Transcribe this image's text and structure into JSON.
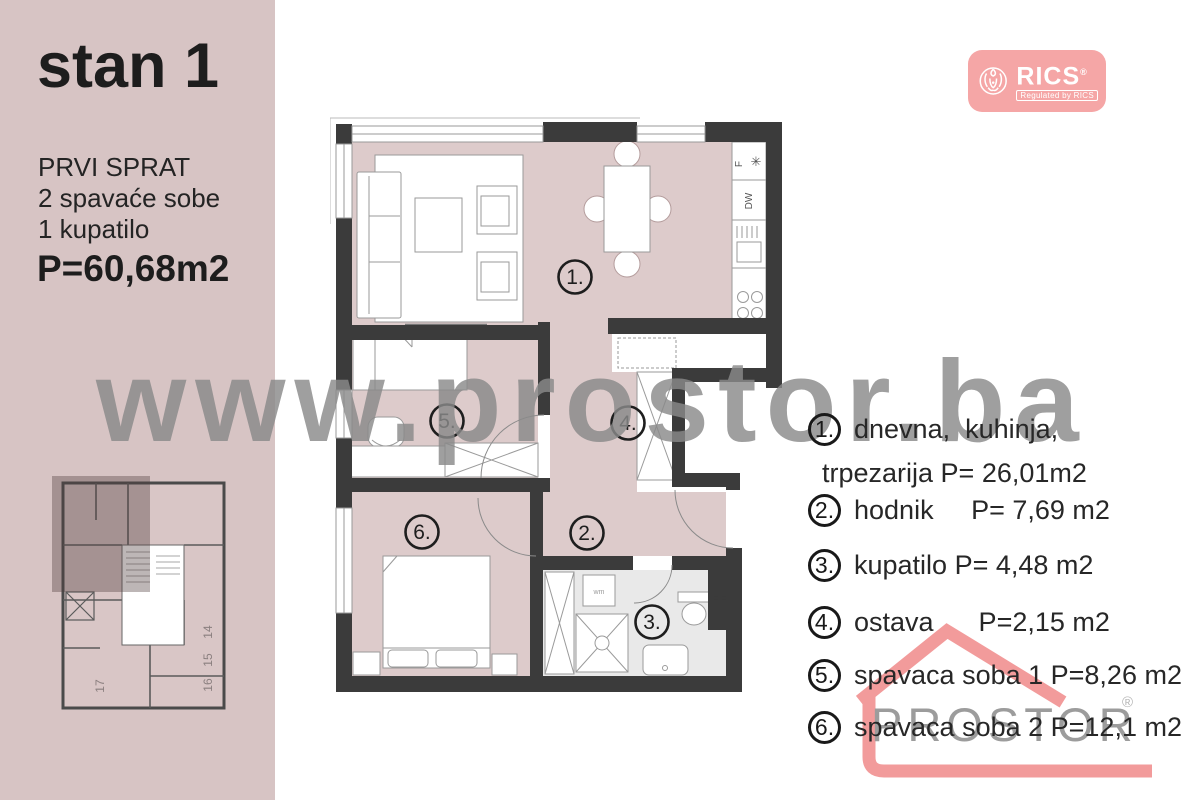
{
  "panel": {
    "title": "stan 1",
    "floor": "PRVI SPRAT",
    "rooms_line": "2 spavaće sobe",
    "bath_line": "1 kupatilo",
    "area": "P=60,68m2"
  },
  "watermark": "www.prostor.ba",
  "rics_badge": {
    "brand": "RICS",
    "reg": "®",
    "tagline": "Regulated by RICS"
  },
  "prostor_logo": {
    "brand": "PROSTOR",
    "reg": "®"
  },
  "legend": {
    "items": [
      {
        "num": "1.",
        "lines": [
          "dnevna,  kuhinja,",
          "trpezarija P= 26,01m2"
        ]
      },
      {
        "num": "2.",
        "lines": [
          "hodnik     P= 7,69 m2",
          ""
        ]
      },
      {
        "num": "3.",
        "lines": [
          "kupatilo P= 4,48 m2",
          ""
        ]
      },
      {
        "num": "4.",
        "lines": [
          "ostava      P=2,15 m2",
          ""
        ]
      },
      {
        "num": "5.",
        "lines": [
          "spavaca soba 1 P=8,26 m2",
          ""
        ]
      },
      {
        "num": "6.",
        "lines": [
          "spavaca soba 2 P=12,1 m2",
          ""
        ]
      }
    ]
  },
  "plan": {
    "room_labels": {
      "r1": "1.",
      "r2": "2.",
      "r3": "3.",
      "r4": "4.",
      "r5": "5.",
      "r6": "6."
    },
    "appliances": {
      "fridge": "F",
      "fridge_symbol": "✳",
      "dishwasher": "DW",
      "washer": "wm"
    },
    "keyplan_units": {
      "u14": "14",
      "u15": "15",
      "u16": "16",
      "u17": "17"
    }
  },
  "colors": {
    "panel_pink": "#d7c4c4",
    "room_pink": "#ddcbcb",
    "wall_dark": "#3b3b3b",
    "bath_gray": "#e9e9e9",
    "watermark_gray": "#8a8a8a",
    "brand_pink": "#f29b9b",
    "rics_pink": "#f5a6a6",
    "logo_text_gray": "#9c9c9c"
  }
}
